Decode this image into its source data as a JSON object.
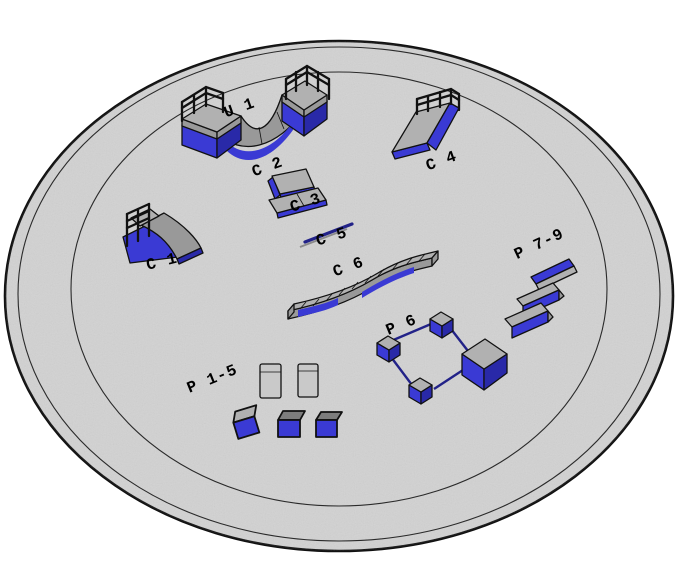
{
  "labels": {
    "u1": "U 1",
    "c1": "C 1",
    "c2": "C 2",
    "c3": "C 3",
    "c4": "C 4",
    "c5": "C 5",
    "c6": "C 6",
    "p1_5": "P 1-5",
    "p6": "P 6",
    "p7_9": "P 7-9"
  },
  "colors": {
    "background": "#ffffff",
    "ground": "#d2d2d2",
    "outline": "#111111",
    "ring_line": "#2a2a2a",
    "object_top": "#b1b1b1",
    "object_side": "#999999",
    "object_blue": "#3a3ad4",
    "object_blue_dark": "#2929a8",
    "rail_blue": "#222288",
    "pad_gray": "#c9c9c9",
    "cube_top_gray": "#7d7d7d",
    "label_text": "#000000"
  }
}
